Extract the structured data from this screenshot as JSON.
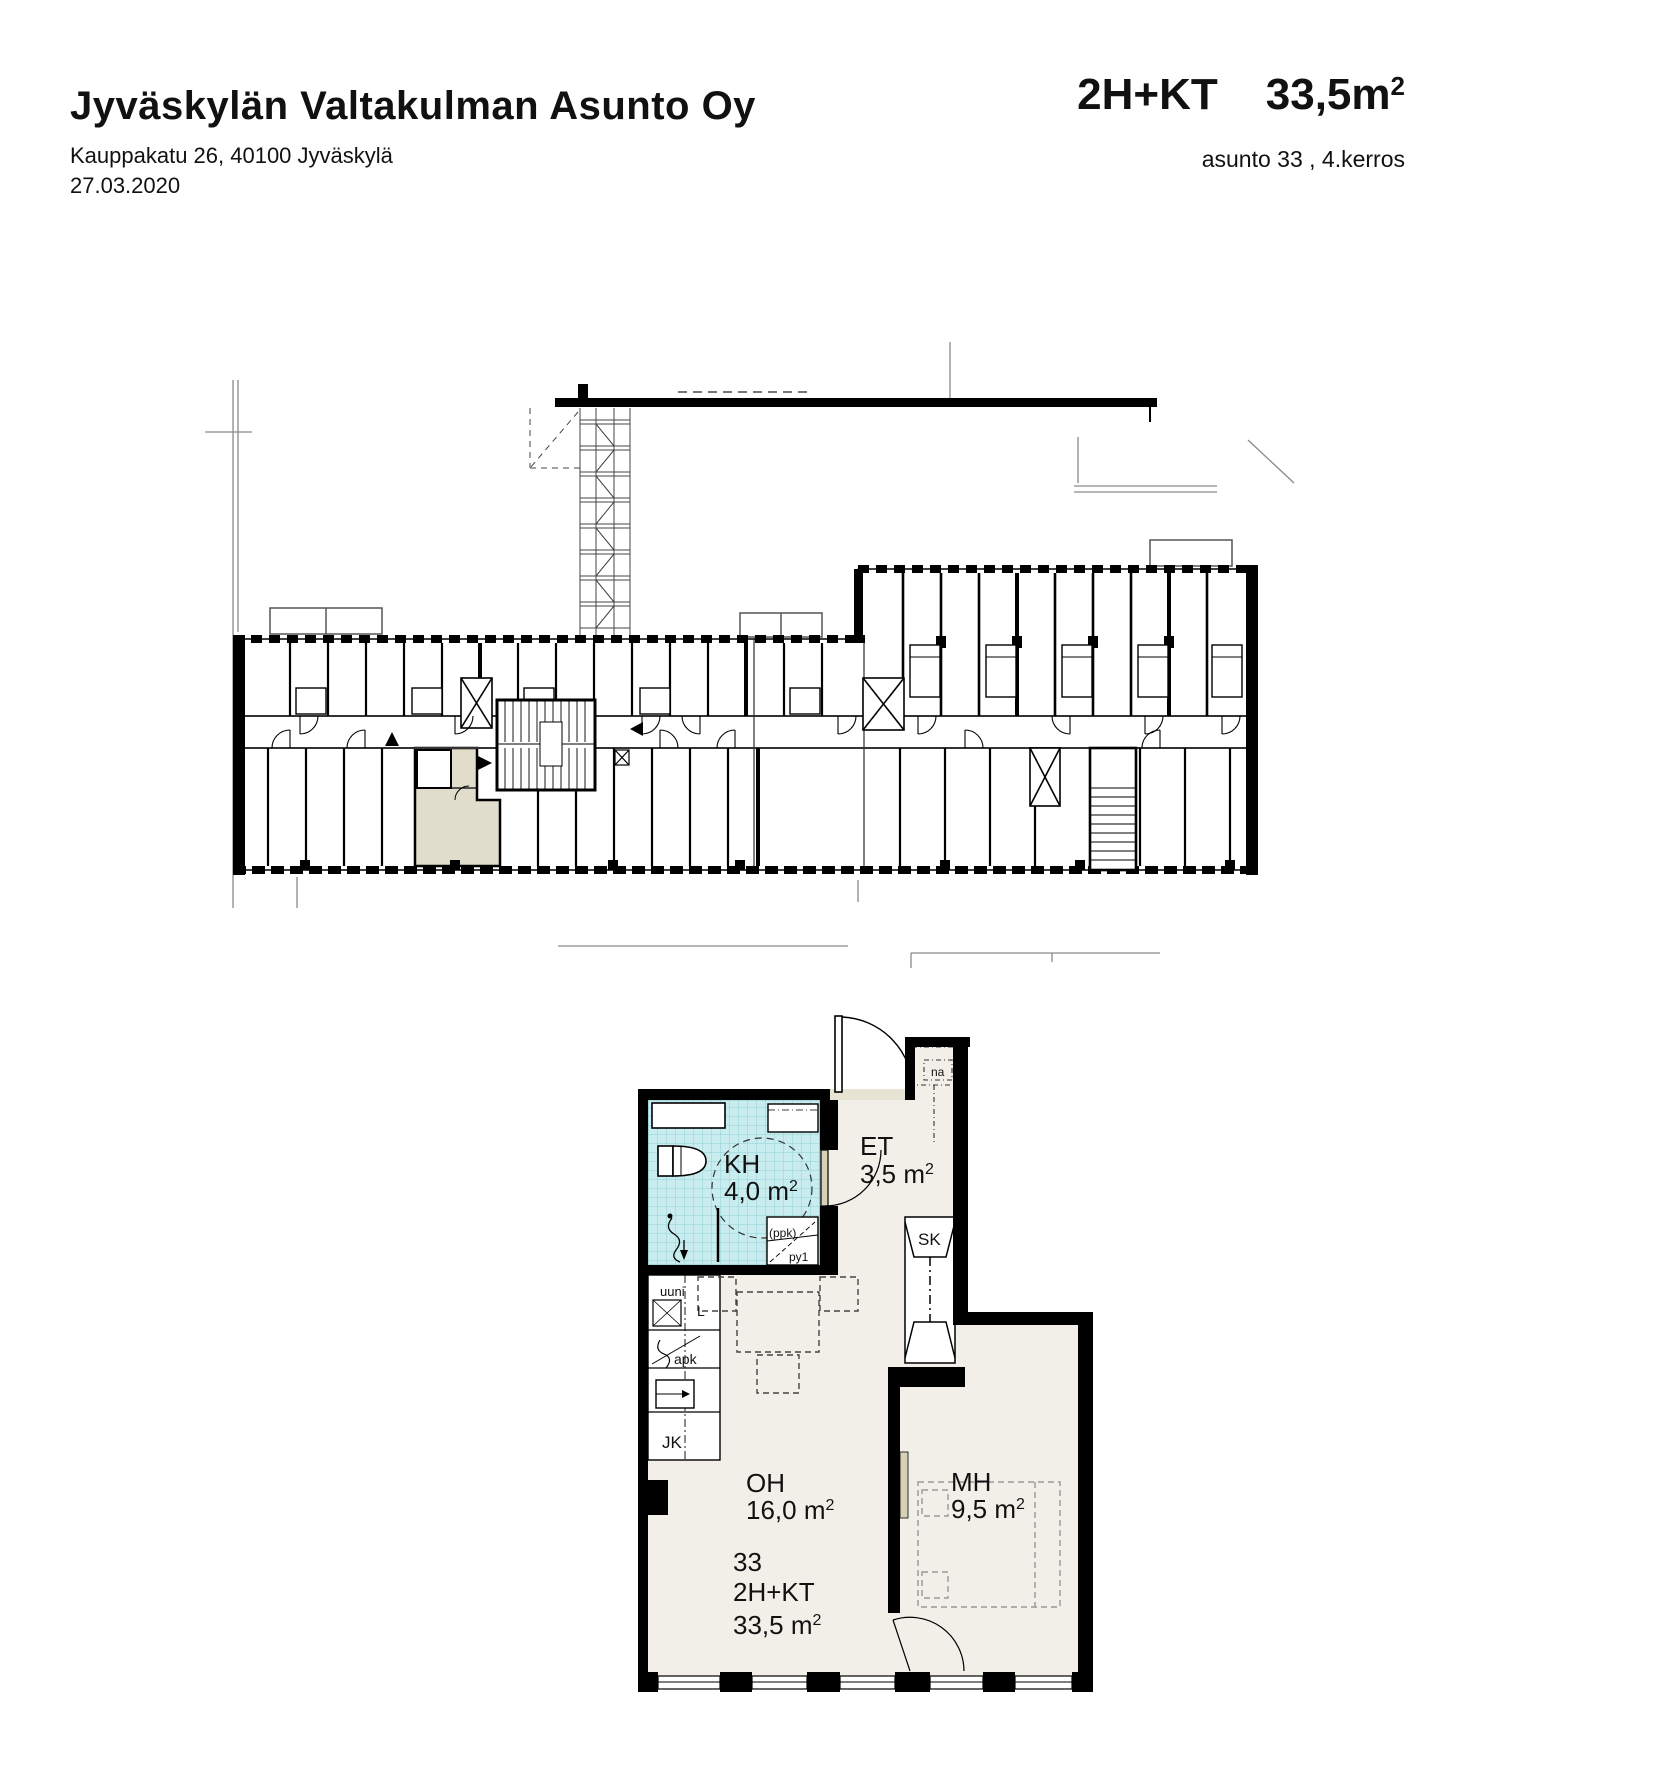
{
  "sup2": "2",
  "header": {
    "title": "Jyväskylän Valtakulman Asunto Oy",
    "address": "Kauppakatu 26, 40100 Jyväskylä",
    "date": "27.03.2020",
    "apt_type": "2H+KT",
    "apt_area_value": "33,5m",
    "apt_line2": "asunto 33 , 4.kerros"
  },
  "overview_plan": {
    "description": "floor overview with highlighted apartment",
    "highlight_color": "#e0ddcc"
  },
  "detail_plan": {
    "rooms": {
      "kh_label": "KH",
      "kh_area_value": "4,0 m",
      "et_label": "ET",
      "et_area_value": "3,5 m",
      "oh_label": "OH",
      "oh_area_value": "16,0 m",
      "mh_label": "MH",
      "mh_area_value": "9,5 m",
      "sk_label": "SK"
    },
    "fixtures": {
      "uuni": "uuni",
      "liesi": "L",
      "apk": "apk",
      "jk": "JK",
      "ppk": "(ppk)",
      "py1": "py1",
      "na": "na"
    },
    "apartment": {
      "number": "33",
      "type": "2H+KT",
      "area_value": "33,5 m"
    },
    "colors": {
      "highlight": "#e0ddcc",
      "floor": "#f1efe8",
      "tile": "#c9ecef",
      "door": "#d8d1b6"
    }
  }
}
